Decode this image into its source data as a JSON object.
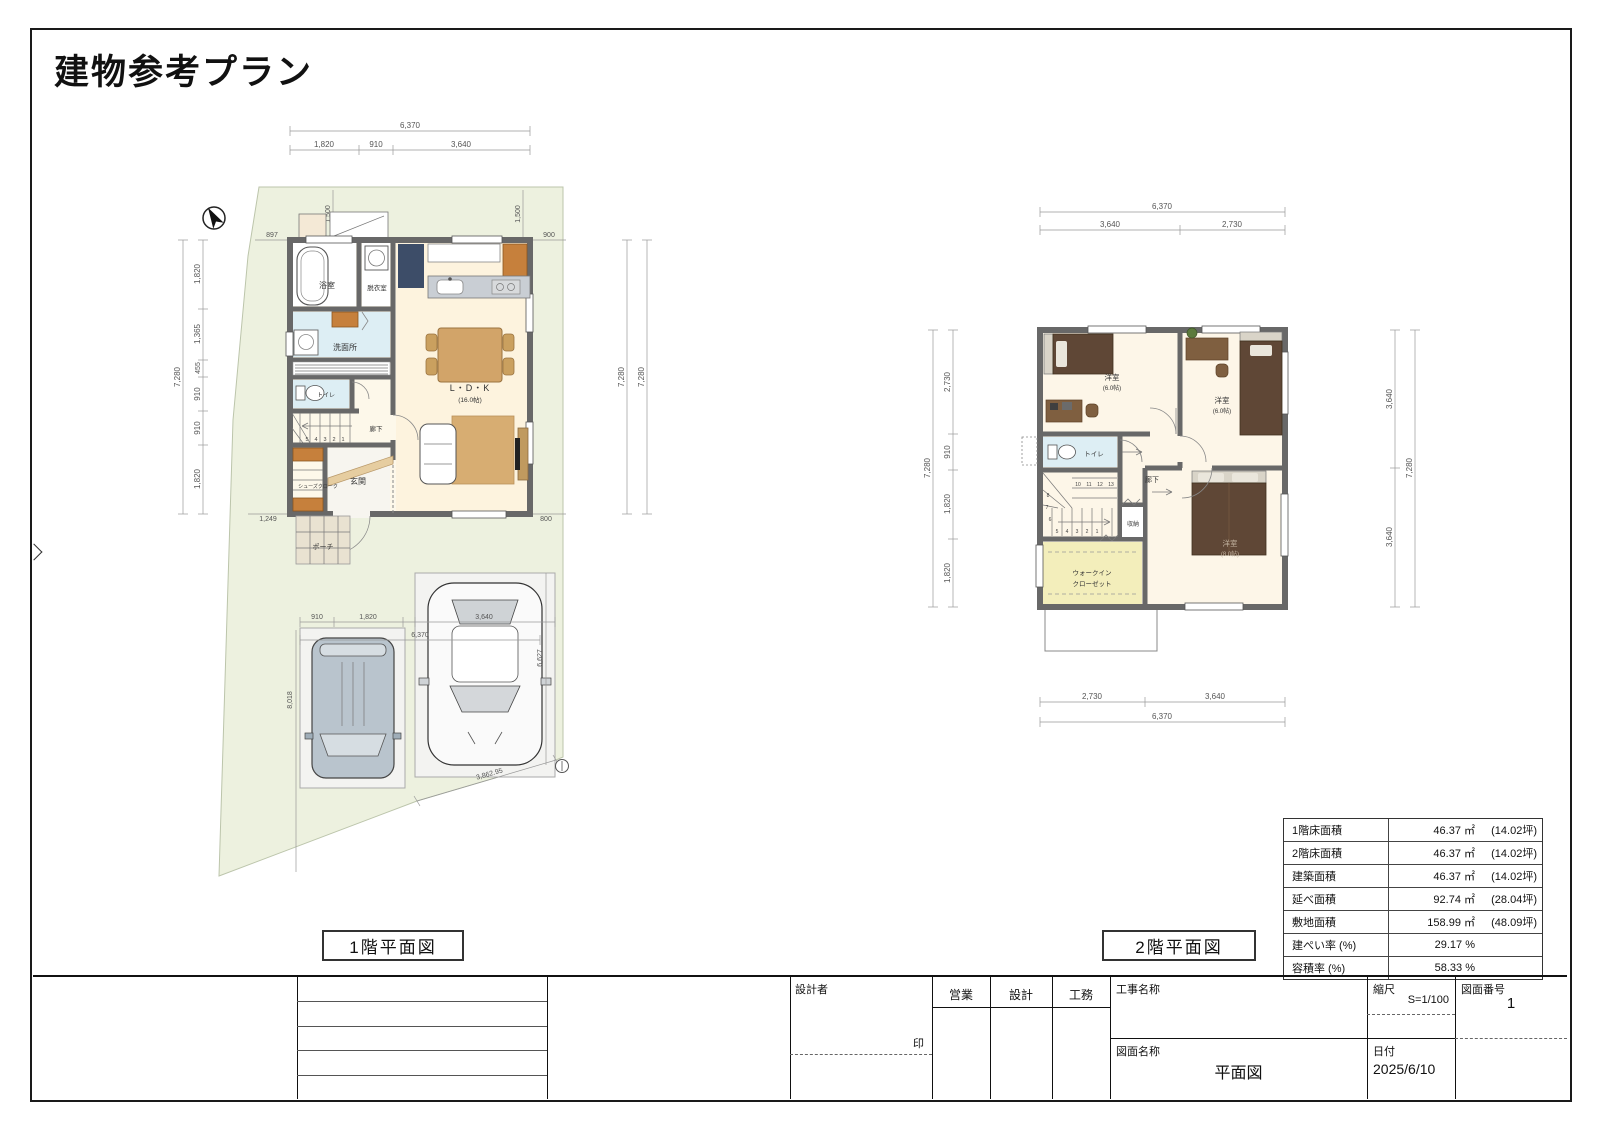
{
  "page": {
    "title": "建物参考プラン",
    "plan1_caption": "1階平面図",
    "plan2_caption": "2階平面図"
  },
  "plan1": {
    "dims": {
      "top_total": "6,370",
      "top": [
        "1,820",
        "910",
        "3,640"
      ],
      "left_total": "7,280",
      "left": [
        "1,820",
        "1,365",
        "455",
        "910",
        "910",
        "1,820"
      ],
      "right": [
        "7,280",
        "7,280"
      ],
      "setback_left": "1,500",
      "setback_right": "1,500",
      "offset_tl": "897",
      "offset_tr": "900",
      "offset_bl": "1,249",
      "offset_br": "800",
      "park_w1": "910",
      "park_w2": "1,820",
      "park_w3": "3,640",
      "park_total": "6,370",
      "site_left": "8,018",
      "site_right": "6,627",
      "site_diag": "3,862.95"
    },
    "rooms": {
      "bath": "浴室",
      "dressing": "脱衣室",
      "washroom": "洗面所",
      "toilet": "トイレ",
      "hallway": "廊下",
      "shoes_closet": "シューズクローク",
      "entrance": "玄関",
      "porch": "ポーチ",
      "ldk": "L・D・K",
      "ldk_size": "(16.0帖)"
    },
    "stair_numbers": [
      "5",
      "4",
      "3",
      "2",
      "1"
    ]
  },
  "plan2": {
    "dims": {
      "top_total": "6,370",
      "top": [
        "3,640",
        "2,730"
      ],
      "left_total": "7,280",
      "left": [
        "2,730",
        "910",
        "1,820",
        "1,820"
      ],
      "right_total": "7,280",
      "right": [
        "3,640",
        "3,640"
      ],
      "bottom": [
        "2,730",
        "3,640"
      ],
      "bottom_total": "6,370"
    },
    "rooms": {
      "bedroom1": "洋室",
      "bedroom1_size": "(6.0帖)",
      "bedroom2": "洋室",
      "bedroom2_size": "(6.0帖)",
      "bedroom3": "洋室",
      "bedroom3_size": "(8.0帖)",
      "toilet": "トイレ",
      "hallway": "廊下",
      "storage": "収納",
      "wic_line1": "ウォークイン",
      "wic_line2": "クローゼット"
    },
    "stair_numbers_lower": [
      "5",
      "4",
      "3",
      "2",
      "1"
    ],
    "stair_numbers_upper": [
      "10",
      "11",
      "12",
      "13"
    ],
    "stair_numbers_side": [
      "8",
      "7",
      "6"
    ]
  },
  "area_table": {
    "rows": [
      {
        "label": "1階床面積",
        "value": "46.37 ㎡",
        "tsubo": "(14.02坪)"
      },
      {
        "label": "2階床面積",
        "value": "46.37 ㎡",
        "tsubo": "(14.02坪)"
      },
      {
        "label": "建築面積",
        "value": "46.37 ㎡",
        "tsubo": "(14.02坪)"
      },
      {
        "label": "延べ面積",
        "value": "92.74 ㎡",
        "tsubo": "(28.04坪)"
      },
      {
        "label": "敷地面積",
        "value": "158.99 ㎡",
        "tsubo": "(48.09坪)"
      },
      {
        "label": "建ぺい率 (%)",
        "value": "29.17 %",
        "tsubo": ""
      },
      {
        "label": "容積率 (%)",
        "value": "58.33 %",
        "tsubo": ""
      }
    ]
  },
  "title_block": {
    "designer_label": "設計者",
    "seal_label": "印",
    "sales_label": "営業",
    "design_label": "設計",
    "construction_label": "工務",
    "project_label": "工事名称",
    "drawing_label": "図面名称",
    "drawing_name": "平面図",
    "scale_label": "縮尺",
    "scale_value": "S=1/100",
    "number_label": "図面番号",
    "number_value": "1",
    "date_label": "日付",
    "date_value": "2025/6/10"
  }
}
